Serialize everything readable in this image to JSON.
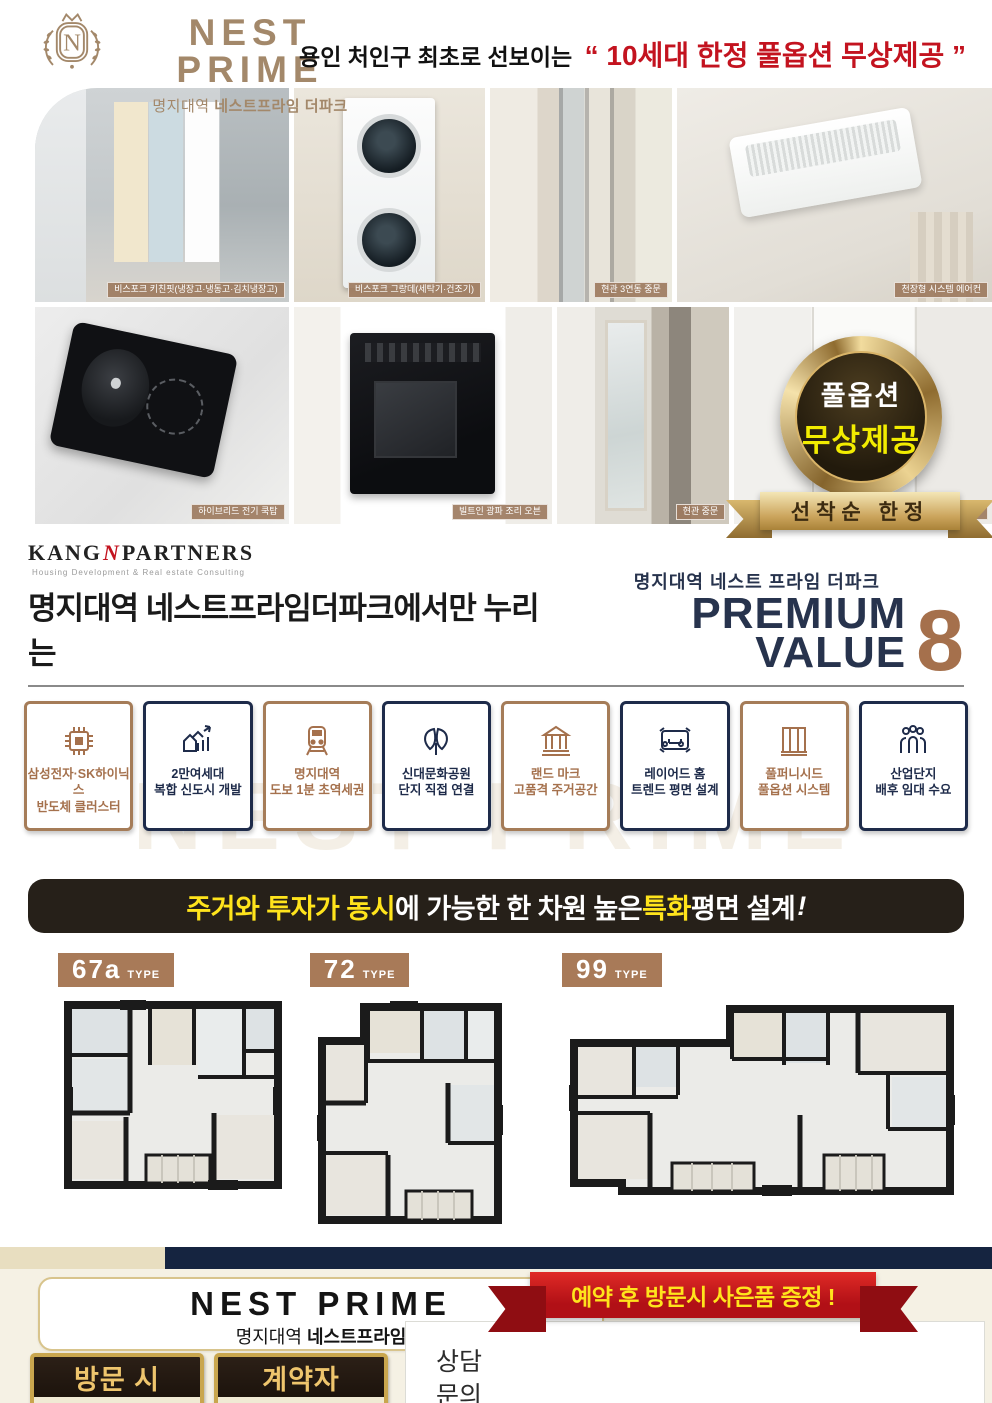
{
  "header": {
    "emblem_letter": "N",
    "brand": "NEST PRIME",
    "brand_sub_light": "명지대역",
    "brand_sub_bold": "네스트프라임 더파크",
    "tagline_prefix": "용인 처인구 최초로 선보이는",
    "tagline_highlight": "“ 10세대 한정 풀옵션 무상제공 ”"
  },
  "gallery": {
    "row1": [
      {
        "caption": "비스포크 키친핏(냉장고·냉동고·김치냉장고)"
      },
      {
        "caption": "비스포크 그랑데(세탁기·건조기)"
      },
      {
        "caption": "현관 3연동 중문"
      },
      {
        "caption": "천장형 시스템 에어컨"
      }
    ],
    "row2": [
      {
        "caption": "하이브리드 전기 쿡탑"
      },
      {
        "caption": "빌트인 광파 조리 오븐"
      },
      {
        "caption": "현관 중문"
      },
      {
        "caption": "3연동 중문"
      }
    ]
  },
  "badge": {
    "line1": "풀옵션",
    "line2": "무상제공",
    "ribbon": "선착순 한정"
  },
  "premium": {
    "partner_left": "KANG",
    "partner_n": "N",
    "partner_right": "PARTNERS",
    "partner_sub": "Housing Development & Real estate Consulting",
    "headline": "명지대역 네스트프라임더파크에서만 누리는",
    "value_overline": "명지대역 네스트 프라임 더파크",
    "value_title": "PREMIUM VALUE",
    "value_number": "8"
  },
  "features": [
    {
      "line1": "삼성전자·SK하이닉스",
      "line2": "반도체 클러스터"
    },
    {
      "line1": "2만여세대",
      "line2": "복합 신도시 개발"
    },
    {
      "line1": "명지대역",
      "line2": "도보 1분 초역세권"
    },
    {
      "line1": "신대문화공원",
      "line2": "단지 직접 연결"
    },
    {
      "line1": "랜드 마크",
      "line2": "고품격 주거공간"
    },
    {
      "line1": "레이어드 홈",
      "line2": "트렌드 평면 설계"
    },
    {
      "line1": "풀퍼니시드",
      "line2": "풀옵션 시스템"
    },
    {
      "line1": "산업단지",
      "line2": "배후 임대 수요"
    }
  ],
  "watermark": "NEST PRIME",
  "banner": {
    "part1": "주거와 투자가 동시",
    "part2": "에 가능한 한 차원 높은 ",
    "part3": "특화",
    "part4": " 평면 설계",
    "part5": "!"
  },
  "plans": [
    {
      "code": "67a",
      "type_label": "TYPE"
    },
    {
      "code": "72",
      "type_label": "TYPE"
    },
    {
      "code": "99",
      "type_label": "TYPE"
    }
  ],
  "footer": {
    "brand": "NEST PRIME",
    "brand_sub_light": "명지대역",
    "brand_sub_bold": "네스트프라임",
    "ribbon": "예약 후 방문시 사은품 증정 !",
    "contact_line1": "상담",
    "contact_line2": "문의",
    "badge1_top": "방문 시",
    "badge1_bottom": "사은품 증정",
    "badge2_top": "계약자",
    "badge2_bottom": "사은품 이벤트",
    "disclaimer": "※ 본 홍보물에 사용된 CG, 이미지 등은 소비자의 이해를 돕기 위한 것으로 실제와 다를수도 있습니다. ※ 본 제작물상의 개발계획(예정) 등은 각 지방자치단체 및 언론 보도자료를 인용한 것으로 국가기관, 지자체 및 기타 관계기관의 사업추진 중 일부 변경, 취소될 수 있습니다."
  },
  "colors": {
    "brand_brown": "#a3886a",
    "accent_brown": "#a57c58",
    "accent_navy": "#1e2b4a",
    "highlight_red": "#c3131f",
    "banner_yellow": "#ffe41c",
    "badge_yellow": "#f2ec00"
  }
}
